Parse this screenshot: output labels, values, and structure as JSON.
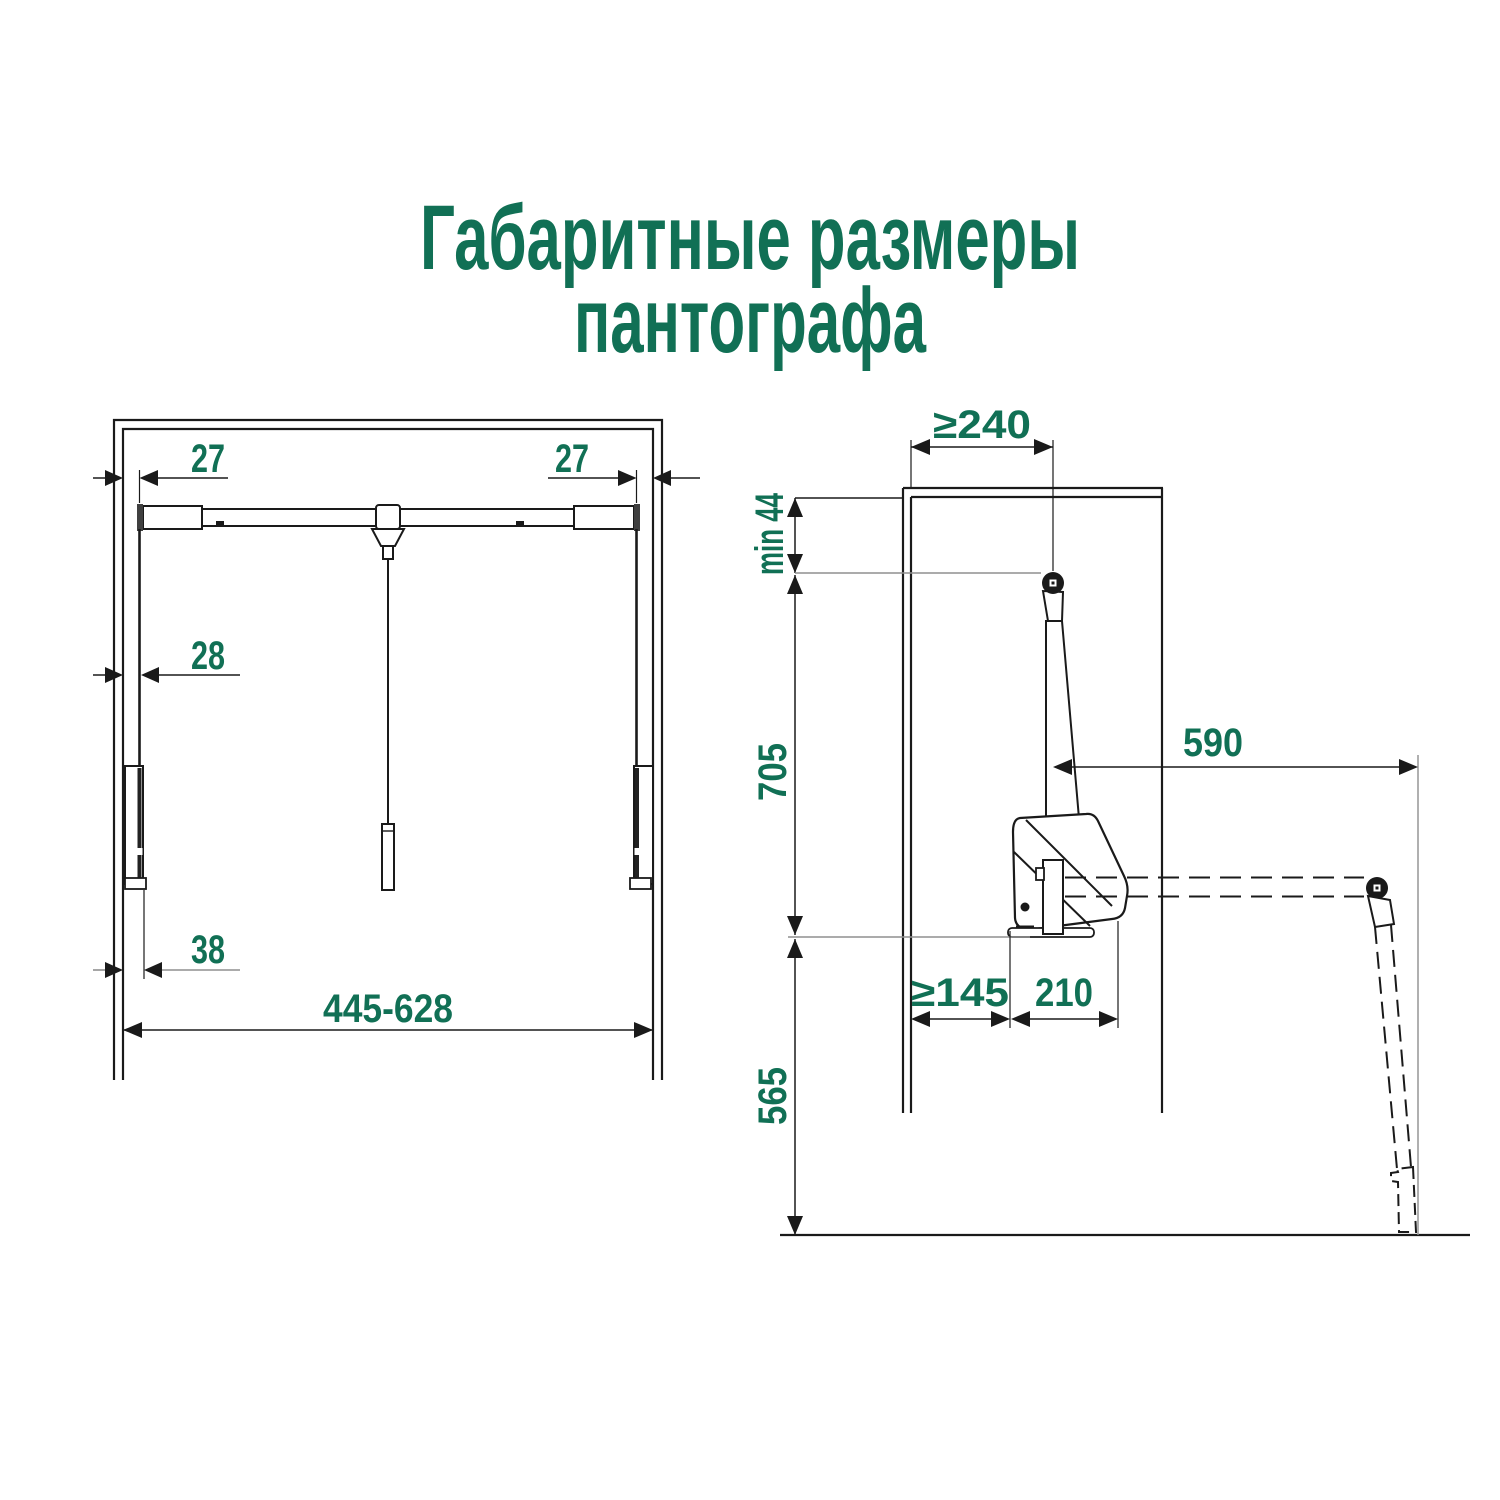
{
  "title": {
    "line1": "Габаритные размеры",
    "line2": "пантографа"
  },
  "colors": {
    "accent_green": "#117055",
    "line_black": "#1a1a1a",
    "dim_gray": "#8f8f8f"
  },
  "front_view": {
    "description": "front view of pantograph inside cabinet",
    "dims": {
      "top_left_offset": "27",
      "top_right_offset": "27",
      "side_offset": "28",
      "rail_offset": "38",
      "width_range": "445-628"
    }
  },
  "side_view": {
    "description": "side view of pantograph with lowered rod position",
    "dims": {
      "depth_to_axis": "≥240",
      "top_clearance": "min 44",
      "upper_height": "705",
      "arm_reach": "590",
      "front_clearance": "≥145",
      "body_depth": "210",
      "lower_height": "565"
    }
  }
}
